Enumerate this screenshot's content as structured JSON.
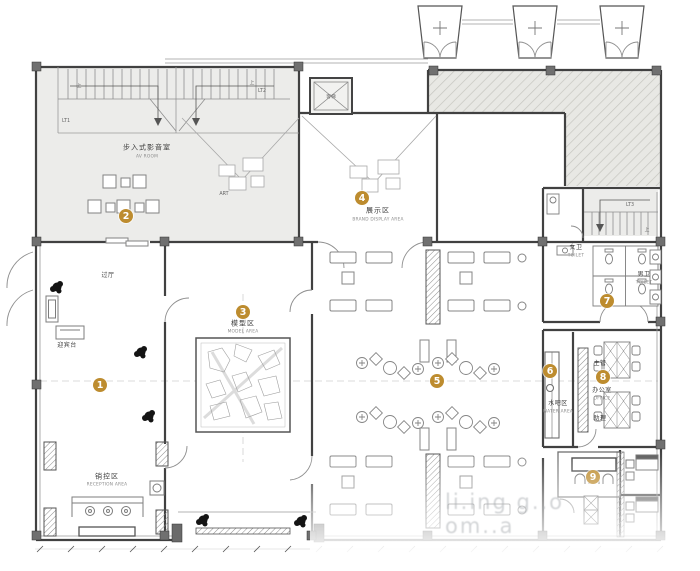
{
  "accent_color": "#BD8C2F",
  "markers": [
    "1",
    "2",
    "3",
    "4",
    "5",
    "6",
    "7",
    "8",
    "9"
  ],
  "rooms": {
    "hallway": {
      "cn": "过厅"
    },
    "welcome_desk": {
      "cn": "迎宾台"
    },
    "av_room": {
      "cn": "步入式影音室",
      "en": "AV ROOM"
    },
    "art_wall": {
      "en": "ART"
    },
    "display": {
      "cn": "展示区",
      "en": "BRAND DISPLAY AREA"
    },
    "model": {
      "cn": "模型区",
      "en": "MODEL AREA"
    },
    "reception": {
      "cn": "销控区",
      "en": "RECEPTION AREA"
    },
    "water_bar": {
      "cn": "水吧区",
      "en": "WATER AREA"
    },
    "women_toilet": {
      "cn": "女卫",
      "en": "TOILET"
    },
    "men_toilet": {
      "cn": "男卫",
      "en": "TOILET"
    },
    "office": {
      "cn": "办公室",
      "en": "OFFICE"
    },
    "supervisor": {
      "cn": "主管"
    },
    "assistant": {
      "cn": "助理"
    },
    "elevator": {
      "cn": "客梯"
    }
  },
  "stairs": {
    "lt1": "LT1",
    "lt2": "LT2",
    "lt3": "LT3",
    "up": "上"
  },
  "watermark": "li.ing g..o om..a"
}
